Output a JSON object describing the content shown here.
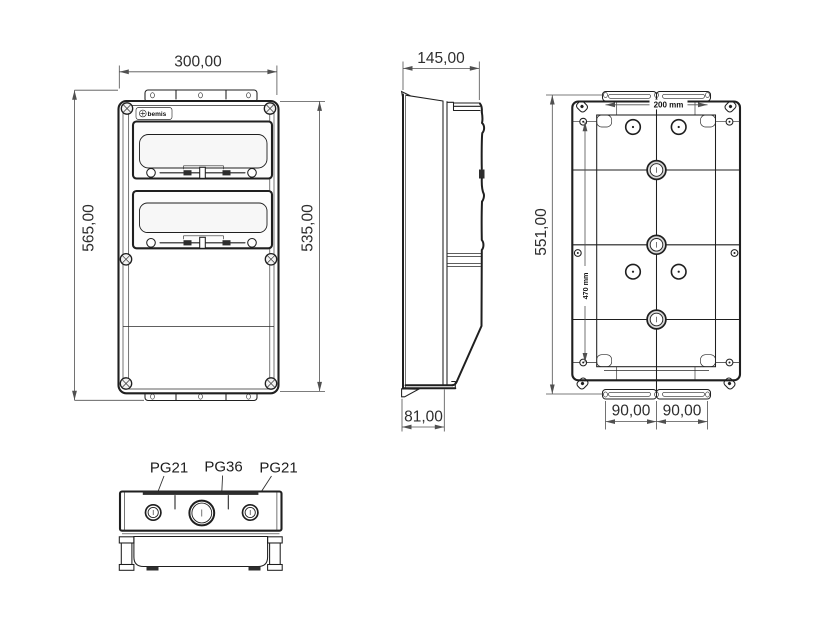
{
  "drawing": {
    "brand": "bemis",
    "front_view": {
      "dim_width": "300,00",
      "dim_overall_height": "565,00",
      "dim_body_height": "535,00"
    },
    "side_view": {
      "dim_depth": "145,00",
      "dim_base_depth": "81,00"
    },
    "back_view": {
      "dim_height": "551,00",
      "dim_top_holes": "200 mm",
      "dim_side_holes": "470 mm",
      "dim_bottom_left": "90,00",
      "dim_bottom_right": "90,00"
    },
    "bottom_view": {
      "gland_left": "PG21",
      "gland_center": "PG36",
      "gland_right": "PG21"
    }
  }
}
